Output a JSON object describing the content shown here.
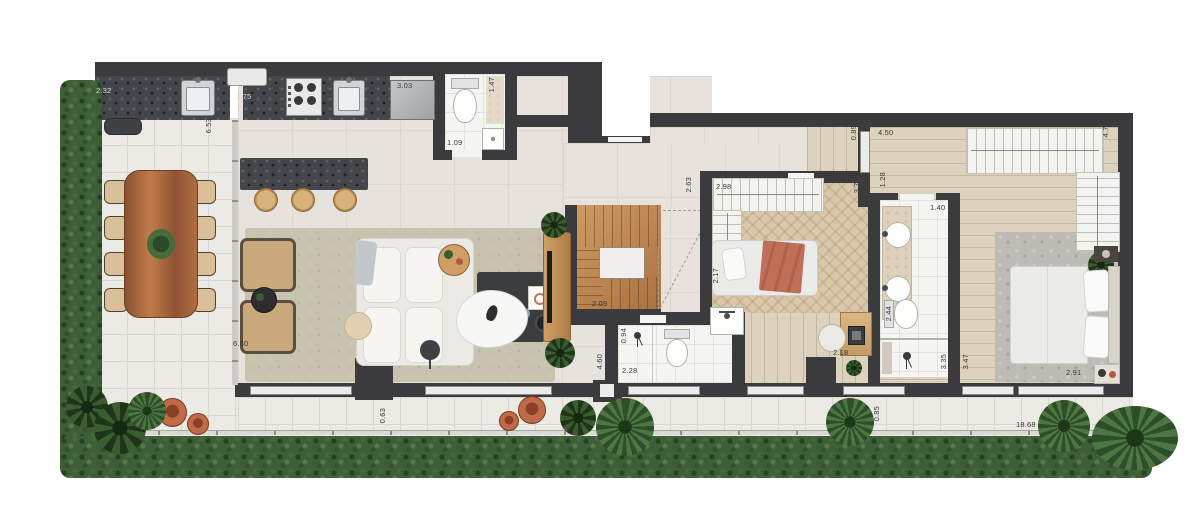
{
  "plan": {
    "type": "residential-floor-plan",
    "visible_text_is_dimensions_only": true
  },
  "dimensions": [
    {
      "value": "2.32",
      "x": 96,
      "y": 86,
      "vertical": false,
      "light": true
    },
    {
      "value": "3.75",
      "x": 236,
      "y": 92,
      "vertical": false,
      "light": true
    },
    {
      "value": "3.03",
      "x": 397,
      "y": 81,
      "vertical": false,
      "light": false
    },
    {
      "value": "1.47",
      "x": 487,
      "y": 77,
      "vertical": true,
      "light": false
    },
    {
      "value": "1.09",
      "x": 447,
      "y": 138,
      "vertical": false,
      "light": false
    },
    {
      "value": "6.53",
      "x": 204,
      "y": 118,
      "vertical": true,
      "light": false
    },
    {
      "value": "2.63",
      "x": 684,
      "y": 177,
      "vertical": true,
      "light": false
    },
    {
      "value": "2.98",
      "x": 716,
      "y": 182,
      "vertical": false,
      "light": false
    },
    {
      "value": "0.89",
      "x": 849,
      "y": 125,
      "vertical": true,
      "light": false
    },
    {
      "value": "4.50",
      "x": 878,
      "y": 128,
      "vertical": false,
      "light": false
    },
    {
      "value": "3.74",
      "x": 852,
      "y": 178,
      "vertical": true,
      "light": false
    },
    {
      "value": "1.28",
      "x": 878,
      "y": 172,
      "vertical": true,
      "light": false
    },
    {
      "value": "4.75",
      "x": 1101,
      "y": 122,
      "vertical": true,
      "light": false
    },
    {
      "value": "1.40",
      "x": 930,
      "y": 203,
      "vertical": false,
      "light": false
    },
    {
      "value": "2.09",
      "x": 592,
      "y": 299,
      "vertical": false,
      "light": false
    },
    {
      "value": "2.17",
      "x": 711,
      "y": 268,
      "vertical": true,
      "light": false
    },
    {
      "value": "0.94",
      "x": 619,
      "y": 328,
      "vertical": true,
      "light": false
    },
    {
      "value": "2.28",
      "x": 622,
      "y": 366,
      "vertical": false,
      "light": false
    },
    {
      "value": "1.40",
      "x": 732,
      "y": 352,
      "vertical": true,
      "light": false
    },
    {
      "value": "2.44",
      "x": 884,
      "y": 306,
      "vertical": true,
      "light": false
    },
    {
      "value": "2.18",
      "x": 833,
      "y": 348,
      "vertical": false,
      "light": false
    },
    {
      "value": "3.35",
      "x": 939,
      "y": 354,
      "vertical": true,
      "light": false
    },
    {
      "value": "3.47",
      "x": 961,
      "y": 354,
      "vertical": true,
      "light": false
    },
    {
      "value": "2.91",
      "x": 1066,
      "y": 368,
      "vertical": false,
      "light": false
    },
    {
      "value": "6.60",
      "x": 233,
      "y": 339,
      "vertical": false,
      "light": false
    },
    {
      "value": "4.60",
      "x": 595,
      "y": 354,
      "vertical": true,
      "light": false
    },
    {
      "value": "0.63",
      "x": 378,
      "y": 408,
      "vertical": true,
      "light": false
    },
    {
      "value": "0.85",
      "x": 872,
      "y": 406,
      "vertical": true,
      "light": false
    },
    {
      "value": "18.68",
      "x": 1016,
      "y": 420,
      "vertical": false,
      "light": false
    }
  ],
  "colors": {
    "wall": "#3b3b3d",
    "terrace_tile": "#eceae4",
    "indoor_tile": "#e7e3dc",
    "bath_tile": "#f5f5f3",
    "wood_light": "#ddd2bd",
    "herringbone": "#d9c8ab",
    "rug_living": "#c7c3ae",
    "rug_master": "#bdbbb5",
    "granite": "#43464a",
    "hedge": "#3e5e37",
    "terracotta": "#b25a3c",
    "blanket": "#c06f58",
    "closet": "#f3f3f0",
    "label": "#3a3a3a"
  }
}
